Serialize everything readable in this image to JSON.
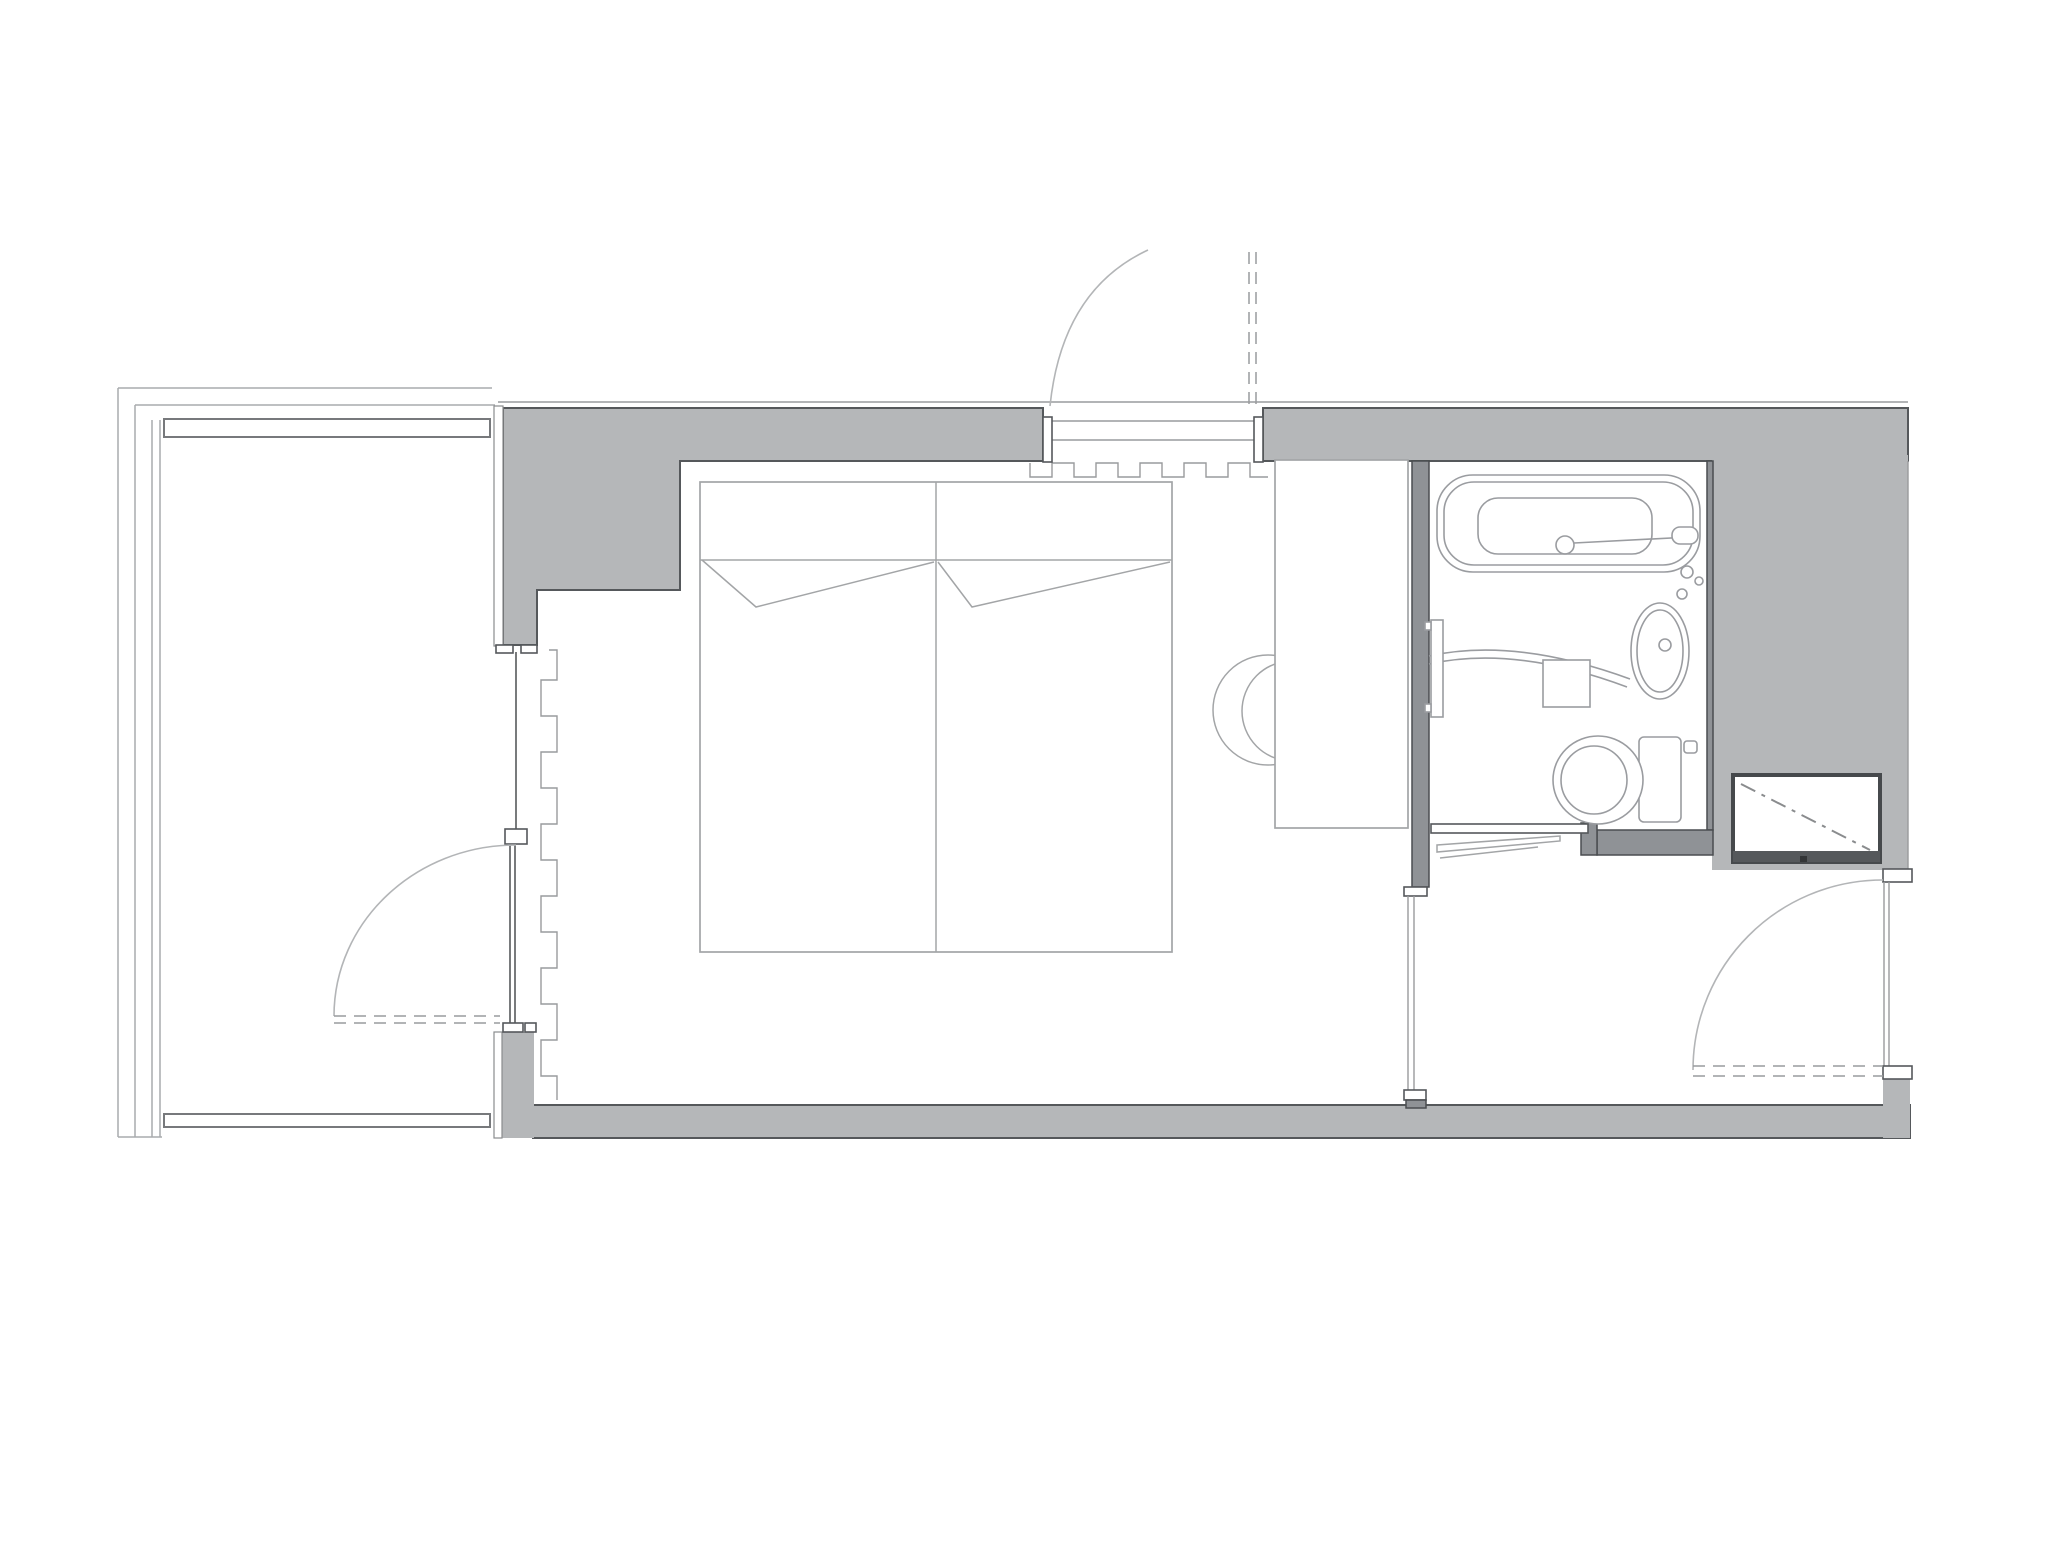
{
  "colors": {
    "wall": "#b5b7b9",
    "wall_stroke": "#55585b",
    "bathwall": "#8f9296",
    "bathwall_stroke": "#4a4d50",
    "fixture": "#9a9ca0",
    "furniture": "#a3a5a7",
    "thin": "#999b9d",
    "arc": "#b3b5b7",
    "closet_stroke": "#46494c",
    "background": "#ffffff"
  },
  "plan": {
    "type": "architectural-floor-plan",
    "elements": [
      "balcony-railing",
      "balcony-door",
      "curtain",
      "twin-bed",
      "pillows",
      "desk-counter",
      "chair",
      "entry-door-top",
      "entry-threshold",
      "bathroom",
      "bathtub",
      "washbasin",
      "toilet",
      "towel-rail",
      "shelf-box",
      "sliding-bathroom-door",
      "luggage-closet",
      "main-entrance-door",
      "service-shaft-wall"
    ]
  }
}
